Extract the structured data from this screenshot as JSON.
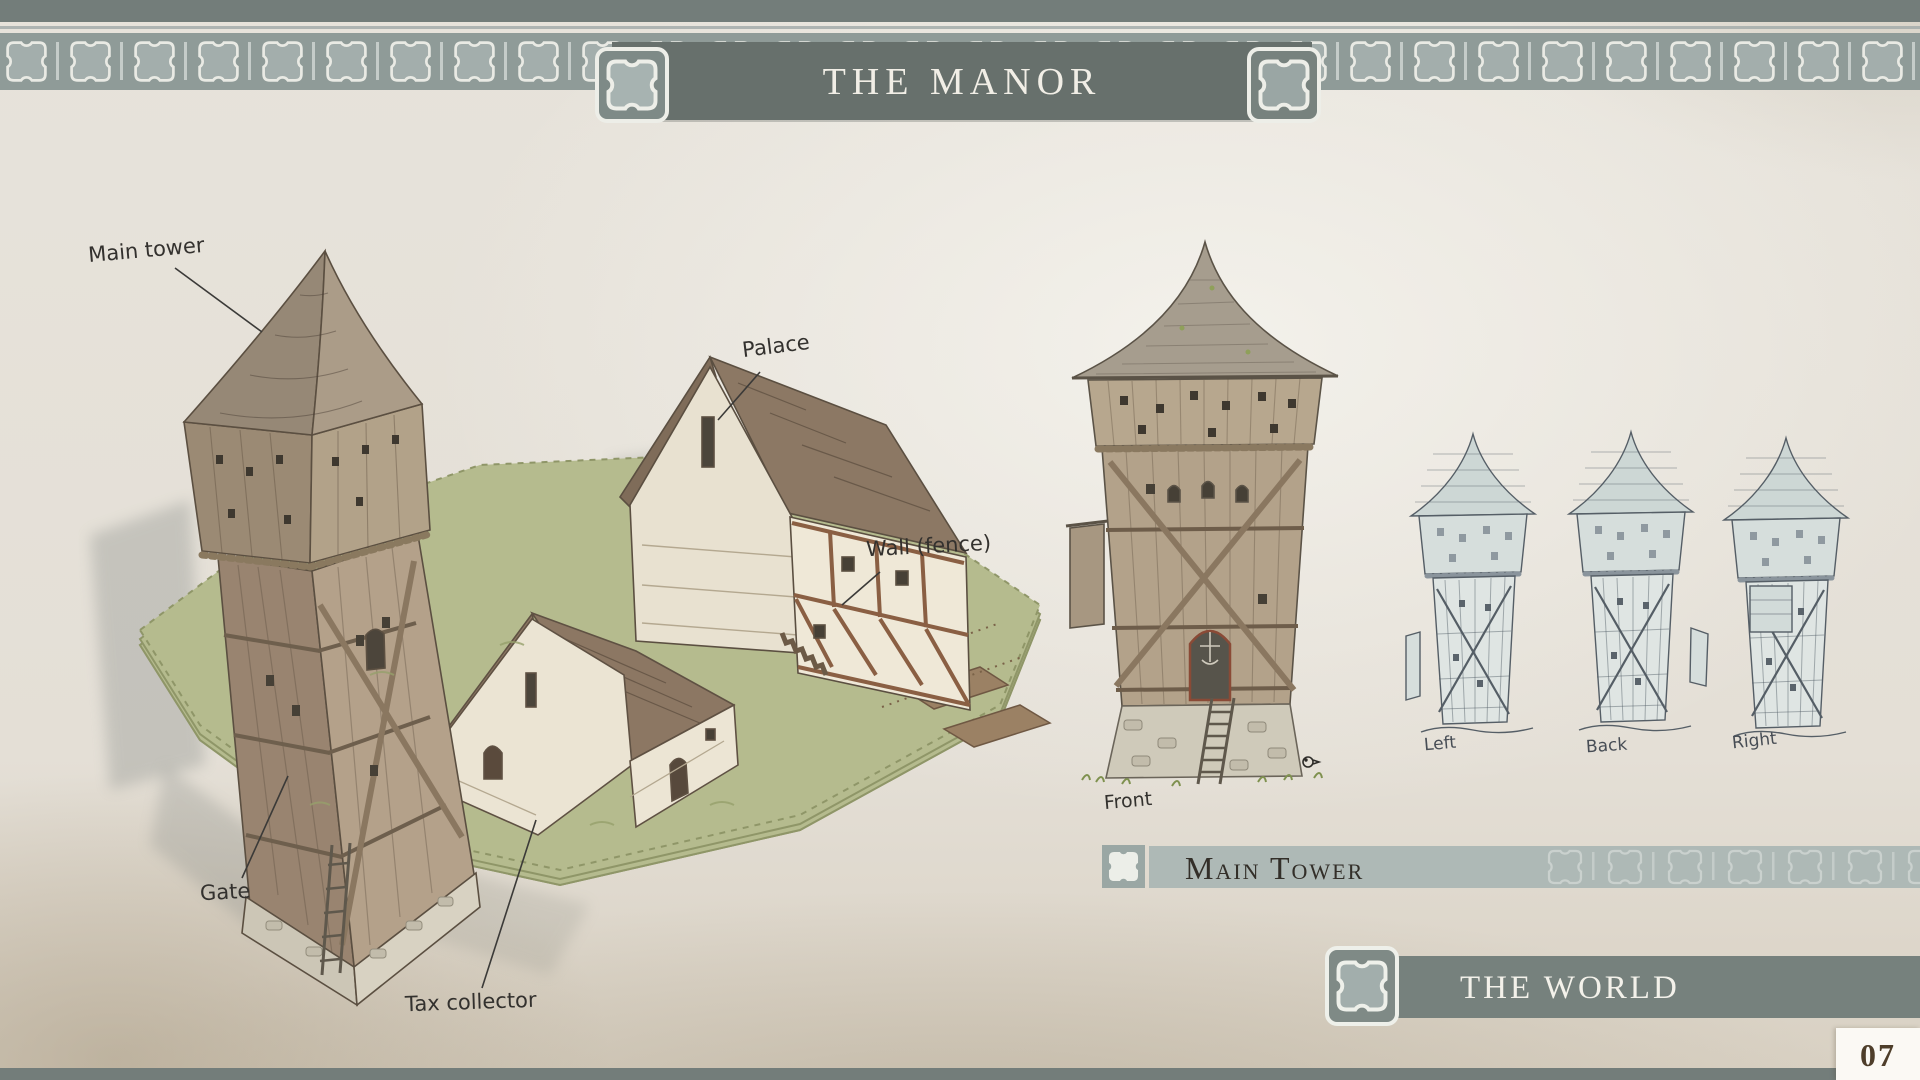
{
  "header": {
    "title": "THE MANOR"
  },
  "manor_sketch": {
    "labels": {
      "main_tower": "Main tower",
      "palace": "Palace",
      "wall": "Wall (fence)",
      "gate": "Gate",
      "tax_collector": "Tax collector"
    }
  },
  "tower_detail": {
    "section_title": "Main Tower",
    "front_label": "Front",
    "view_labels": [
      "Left",
      "Back",
      "Right"
    ]
  },
  "next_section": {
    "title": "THE WORLD"
  },
  "page_number": "07",
  "icons": {
    "ornament": "puzzle-cross-ornament-icon"
  },
  "colors": {
    "banner": "#67706c",
    "frieze_band": "#8f9b98",
    "section_bar_light": "#aeb9b6",
    "section_bar_dark": "#76817d",
    "page_strip": "#737d7a",
    "paper": "#e7e3db",
    "page_number_ink": "#4e3e2a"
  }
}
